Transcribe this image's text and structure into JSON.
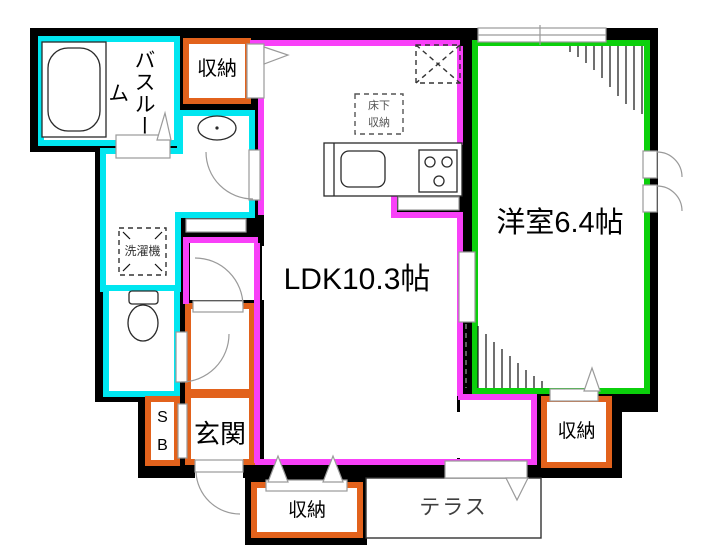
{
  "labels": {
    "bathroom": "バスルーム",
    "storage_top": "収納",
    "washing_machine": "洗濯機",
    "underfloor_storage": "床下\n収納",
    "ldk": "LDK10.3帖",
    "western_room": "洋室6.4帖",
    "shoe_box": "S\nB",
    "entrance": "玄関",
    "storage_right": "収納",
    "storage_bottom": "収納",
    "terrace": "テラス"
  },
  "colors": {
    "water_rooms": "#00e6f0",
    "ldk_walls": "#f840f8",
    "western_room_walls": "#0bd00b",
    "storage_walls": "#e2621c",
    "wall": "#000000",
    "door_symbol": "#9a9a9a"
  }
}
